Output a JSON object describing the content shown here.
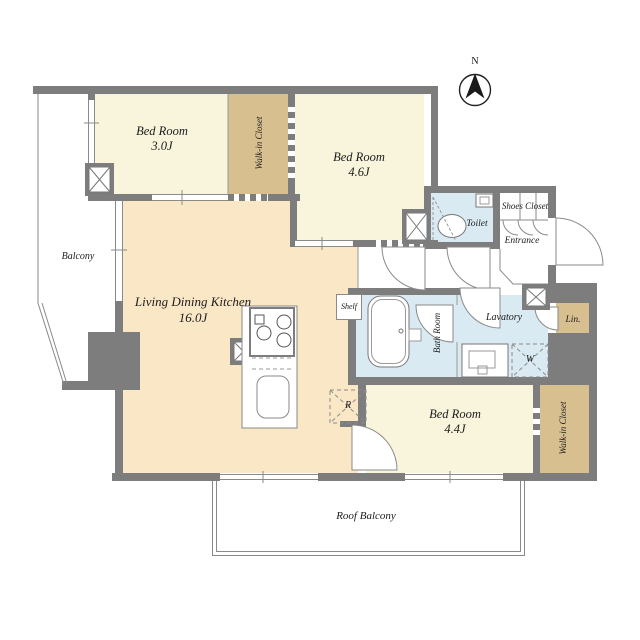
{
  "compass": {
    "north_label": "N"
  },
  "rooms": {
    "bedroom_top_left": {
      "name": "Bed Room",
      "size": "3.0J"
    },
    "bedroom_top_right": {
      "name": "Bed Room",
      "size": "4.6J"
    },
    "bedroom_bottom": {
      "name": "Bed Room",
      "size": "4.4J"
    },
    "living_dining_kitchen": {
      "name": "Living Dining Kitchen",
      "size": "16.0J"
    },
    "walk_in_closet_top": {
      "name": "Walk-in Closet"
    },
    "walk_in_closet_bottom": {
      "name": "Walk-in Closet"
    },
    "balcony": {
      "name": "Balcony"
    },
    "roof_balcony": {
      "name": "Roof Balcony"
    },
    "toilet": {
      "name": "Toilet"
    },
    "bath_room": {
      "name": "Bath Room"
    },
    "lavatory": {
      "name": "Lavatory"
    },
    "entrance": {
      "name": "Entrance"
    },
    "shoes_closet": {
      "name": "Shoes Closet"
    },
    "linen_closet": {
      "name": "Lin."
    },
    "shelf": {
      "name": "Shelf"
    }
  },
  "appliances": {
    "washer_label": "W",
    "refrigerator_label": "R"
  },
  "colors": {
    "wall": "#7d7d7d",
    "bedroom_fill": "#f9f5dc",
    "closet_fill": "#d7bf90",
    "ldk_fill": "#fae7c6",
    "wet_fill": "#d9eaf2",
    "outline": "#8a8a8a",
    "text": "#1c1c1c"
  }
}
